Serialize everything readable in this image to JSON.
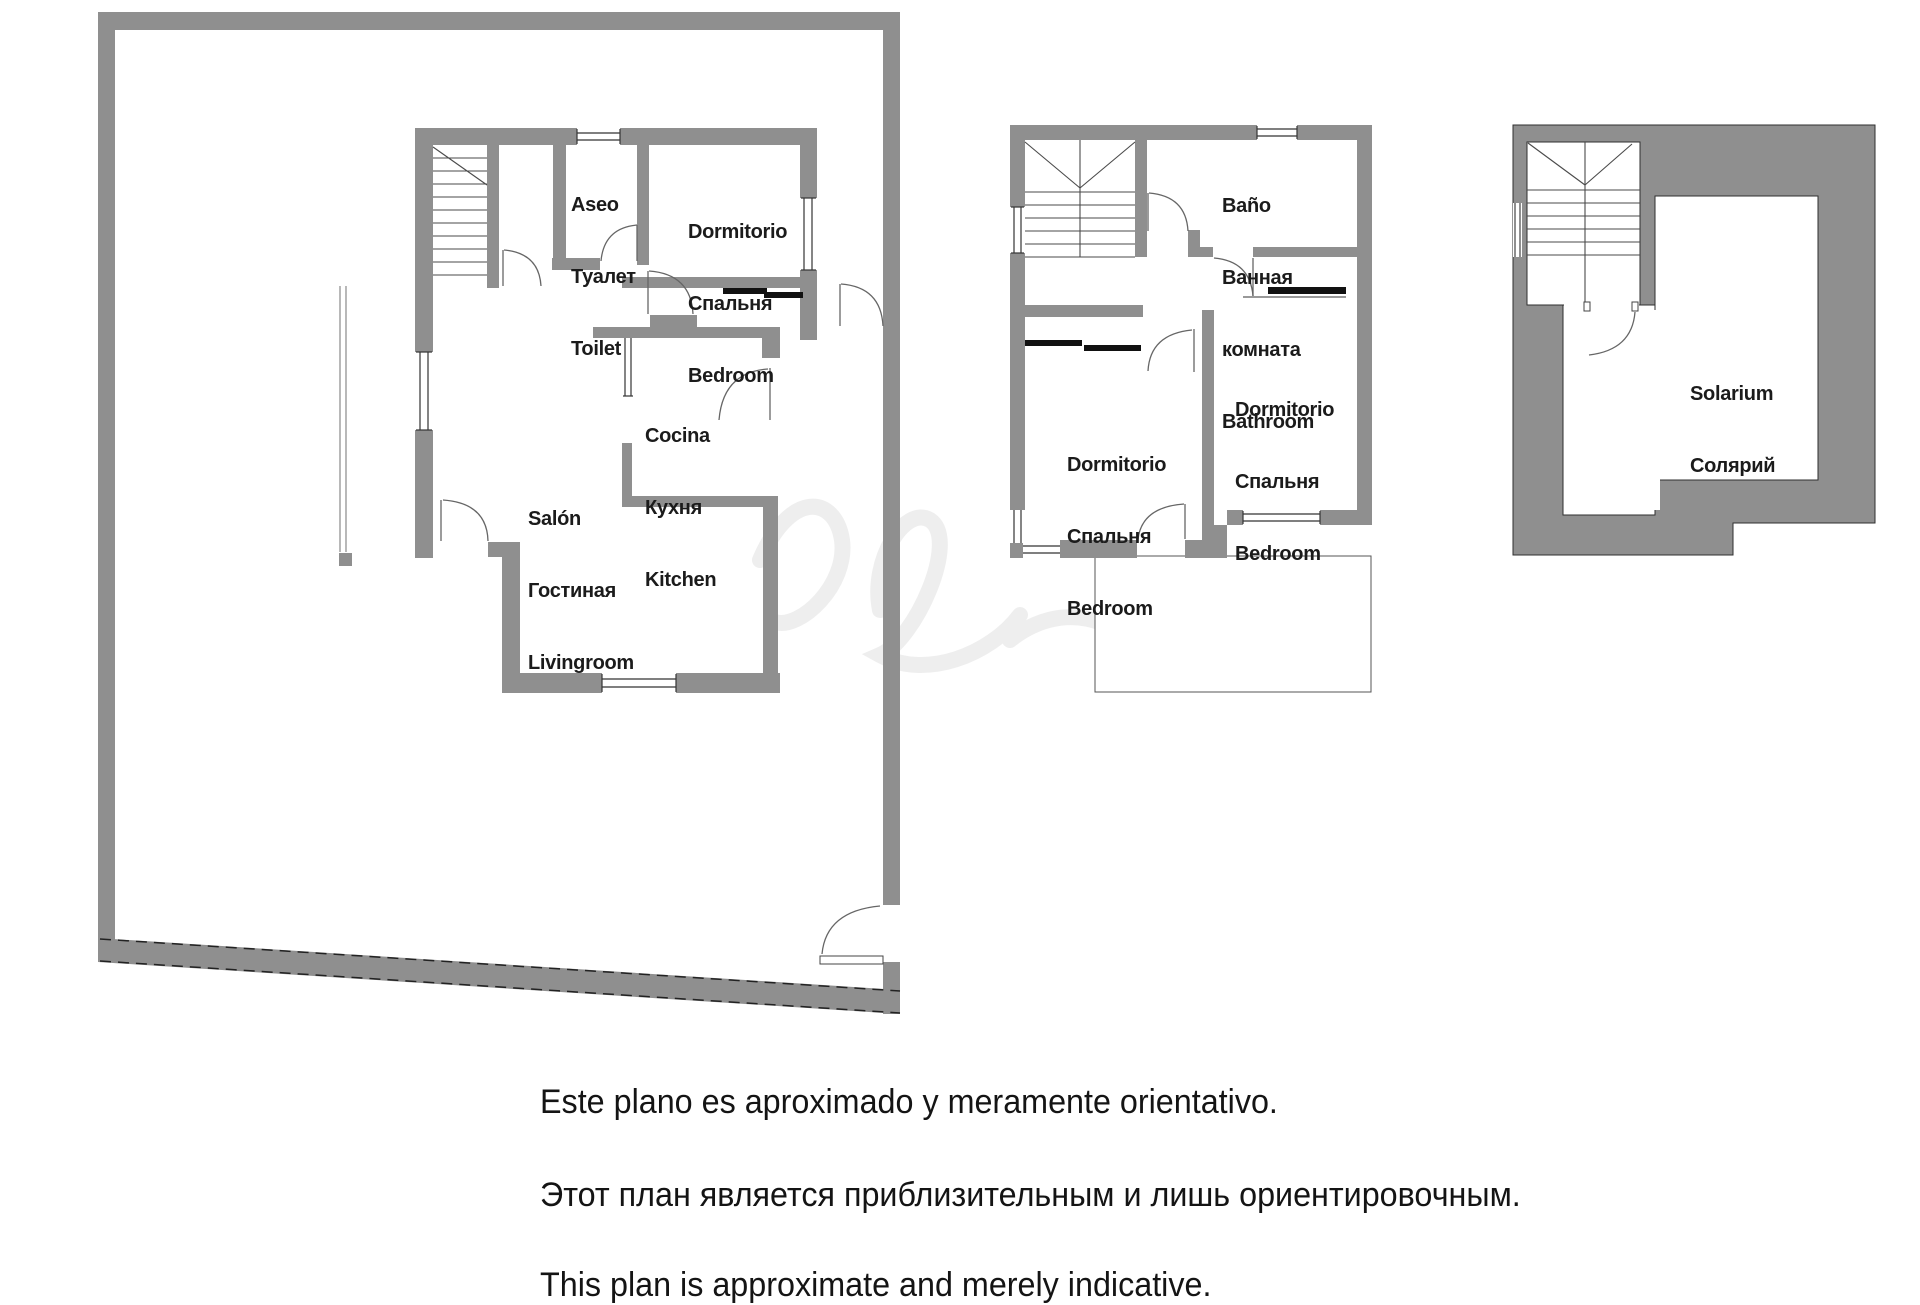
{
  "colors": {
    "wall_gray": "#8f8f8f",
    "line_dark": "#2f2f2f",
    "text": "#1b1b1b"
  },
  "plans": {
    "ground": {
      "title": "ground-floor",
      "rooms": [
        {
          "id": "toilet",
          "lines": [
            "Aseo",
            "Туалет",
            "Toilet"
          ]
        },
        {
          "id": "bedroom",
          "lines": [
            "Dormitorio",
            "Спальня",
            "Bedroom"
          ]
        },
        {
          "id": "kitchen",
          "lines": [
            "Cocina",
            "Кухня",
            "Kitchen"
          ]
        },
        {
          "id": "livingroom",
          "lines": [
            "Salón",
            "Гостиная",
            "Livingroom"
          ]
        }
      ]
    },
    "first": {
      "title": "first-floor",
      "rooms": [
        {
          "id": "bathroom",
          "lines": [
            "Baño",
            "Ванная",
            "комната",
            "Bathroom"
          ]
        },
        {
          "id": "bedroom_right",
          "lines": [
            "Dormitorio",
            "Спальня",
            "Bedroom"
          ]
        },
        {
          "id": "bedroom_left",
          "lines": [
            "Dormitorio",
            "Спальня",
            "Bedroom"
          ]
        }
      ]
    },
    "solarium": {
      "title": "solarium-floor",
      "rooms": [
        {
          "id": "solarium",
          "lines": [
            "Solarium",
            "Солярий"
          ]
        }
      ]
    }
  },
  "footer": {
    "line_es": "Este plano es aproximado y meramente orientativo.",
    "line_ru": "Этот план является приблизительным и лишь ориентировочным.",
    "line_en": "This plan is approximate and merely indicative."
  }
}
